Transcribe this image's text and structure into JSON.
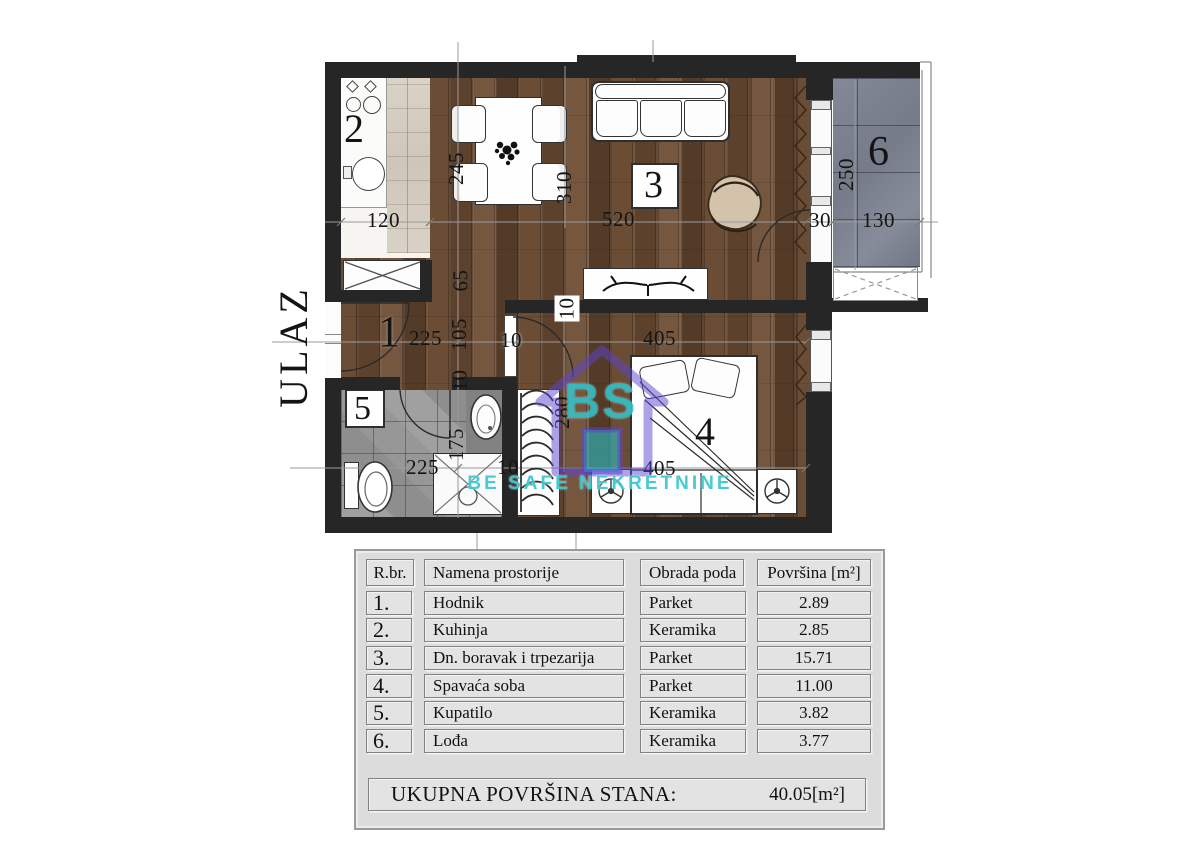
{
  "plan": {
    "entrance_label": "ULAZ",
    "rooms": {
      "r1": "1",
      "r2": "2",
      "r3": "3",
      "r4": "4",
      "r5": "5",
      "r6": "6"
    },
    "dims": {
      "kitchen_width": "120",
      "dining_depth": "245",
      "living_depth": "310",
      "living_width": "520",
      "balcony_door": "30",
      "loggia_width": "130",
      "loggia_depth": "250",
      "passage_width": "65",
      "hall_length": "225",
      "hall_width": "105",
      "hall_wall": "10",
      "bedroom_door_wall": "10",
      "partition_wall": "10",
      "bath_length": "225",
      "bath_width": "175",
      "bath_door_wall": "10",
      "bedroom_width_top": "405",
      "bedroom_depth": "280",
      "bedroom_width_bottom": "405"
    }
  },
  "watermark": {
    "logo_text": "BS",
    "subtitle": "BE SAFE NEKRETNINE",
    "teal": "#2bbfc6",
    "purple": "#5b43cf"
  },
  "table": {
    "headers": {
      "num": "R.br.",
      "name": "Namena prostorije",
      "floor": "Obrada poda",
      "area": "Površina [m²]"
    },
    "rows": [
      {
        "num": "1.",
        "name": "Hodnik",
        "floor": "Parket",
        "area": "2.89"
      },
      {
        "num": "2.",
        "name": "Kuhinja",
        "floor": "Keramika",
        "area": "2.85"
      },
      {
        "num": "3.",
        "name": "Dn. boravak i trpezarija",
        "floor": "Parket",
        "area": "15.71"
      },
      {
        "num": "4.",
        "name": "Spavaća soba",
        "floor": "Parket",
        "area": "11.00"
      },
      {
        "num": "5.",
        "name": "Kupatilo",
        "floor": "Keramika",
        "area": "3.82"
      },
      {
        "num": "6.",
        "name": "Lođa",
        "floor": "Keramika",
        "area": "3.77"
      }
    ],
    "total_label": "UKUPNA POVRŠINA STANA:",
    "total_value": "40.05[m²]"
  }
}
